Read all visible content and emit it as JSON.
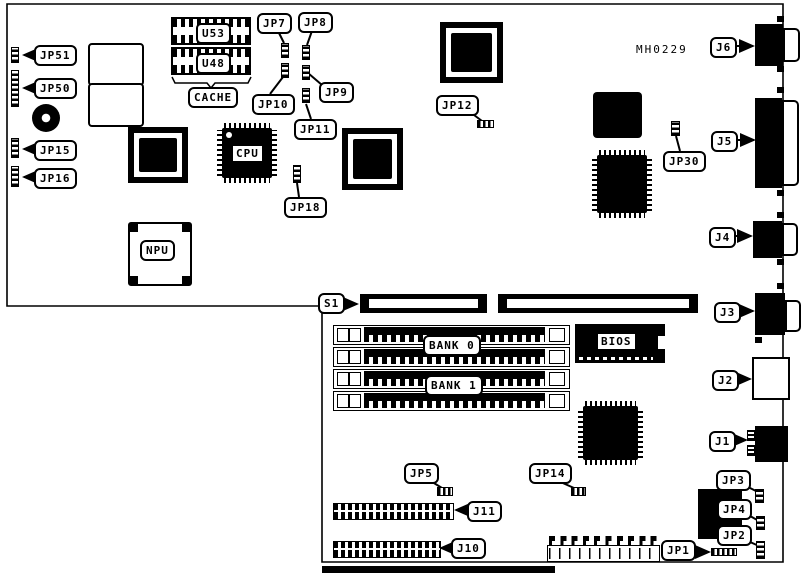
{
  "board": {
    "ref_code": "MH0229"
  },
  "callouts": {
    "jp51": "JP51",
    "jp50": "JP50",
    "jp15": "JP15",
    "jp16": "JP16",
    "jp7": "JP7",
    "jp8": "JP8",
    "jp9": "JP9",
    "jp10": "JP10",
    "jp11": "JP11",
    "jp18": "JP18",
    "jp12": "JP12",
    "jp30": "JP30",
    "s1": "S1",
    "j6": "J6",
    "j5": "J5",
    "j4": "J4",
    "j3": "J3",
    "j2": "J2",
    "j1": "J1",
    "jp5": "JP5",
    "jp14": "JP14",
    "j11": "J11",
    "j10": "J10",
    "jp1": "JP1",
    "jp2": "JP2",
    "jp3": "JP3",
    "jp4": "JP4"
  },
  "components": {
    "u53": "U53",
    "u48": "U48",
    "cache": "CACHE",
    "cpu": "CPU",
    "npu": "NPU",
    "bios": "BIOS",
    "bank0": "BANK 0",
    "bank1": "BANK 1"
  }
}
